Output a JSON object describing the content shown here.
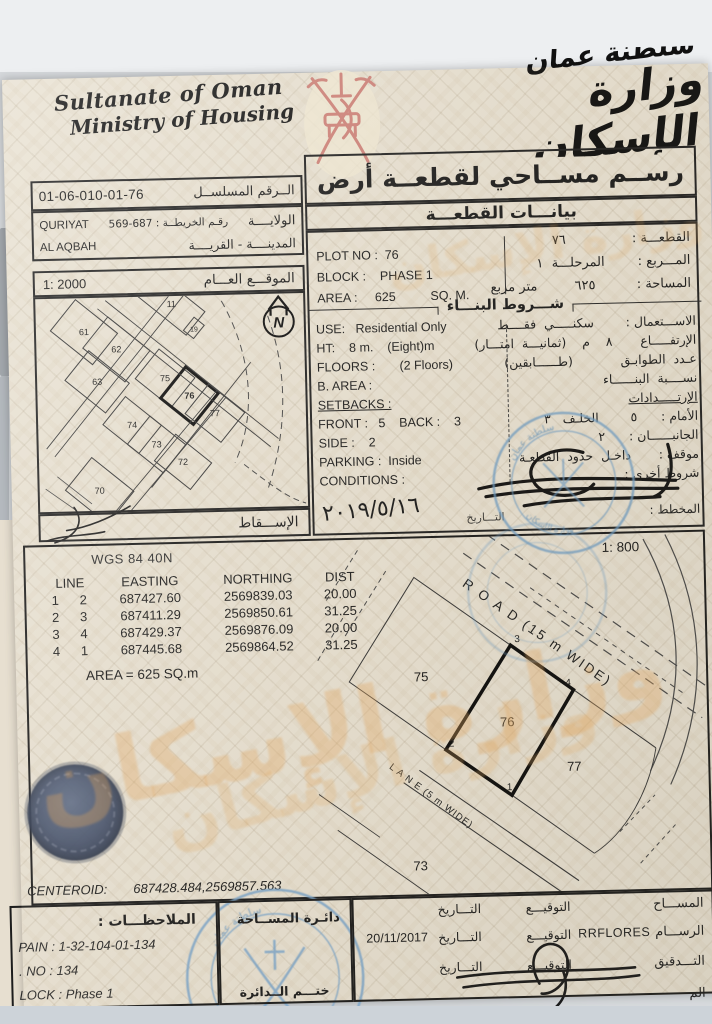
{
  "header": {
    "en_line1": "Sultanate of Oman",
    "en_line2": "Ministry of Housing",
    "ar_top": "سلطنة عمان",
    "ar_main": "وزارة الإسكان",
    "emblem": "oman-national-emblem"
  },
  "serial": {
    "label": "الــرقم  المسلســل",
    "value": "01-06-010-01-76"
  },
  "region": {
    "wilaya_label": "الولايــــة",
    "map_no": "رقـم الخريطــة :  687-569",
    "wilaya_value": "QURIYAT",
    "city_label": "المدينــــة - القريــــة",
    "city_value": "AL AQBAH"
  },
  "doc_title": {
    "main": "رســم  مســاحي  لقطعــة  أرض",
    "sub": "بيانـــات  القطعـــة"
  },
  "plot_info": {
    "ar": [
      "القطعـــة :                ٧٦",
      "المـــربع :        المرحلـــة  ١",
      "المساحة :          ٦٢٥         متر مربع"
    ],
    "en": [
      "PLOT NO :  76",
      "BLOCK :    PHASE 1",
      "AREA :     625          SQ. M."
    ]
  },
  "building": {
    "header": "شـــروط  البنـــاء",
    "rows": [
      {
        "en": "USE:   Residential Only",
        "ar": "الاســـتعمال :        سكنـــــي  فقــــط"
      },
      {
        "en": "HT:    8 m.    (Eight)m",
        "ar": "الإرتفـــــاع       ٨    م    (ثمانيـــة  امتـــار)"
      },
      {
        "en": "FLOORS :       (2 Floors)",
        "ar": "عـدد  الطوابـق            (طــــــابقين)"
      },
      {
        "en": "B. AREA :",
        "ar": "نســــبة  البنــــــاء"
      },
      {
        "en": "SETBACKS :",
        "ar": "الإرتـــــدادات"
      },
      {
        "en": "FRONT :   5    BACK :    3",
        "ar": "الأمام :      ٥        الخلـف   ٣"
      },
      {
        "en": "SIDE :    2",
        "ar": "الجانبــــــان :      ٢"
      },
      {
        "en": "PARKING :  Inside",
        "ar": "موقف :       داخـل  حدود  القطعـة"
      },
      {
        "en": "CONDITIONS :",
        "ar": "شروط أخرى :"
      }
    ],
    "planner_label": "المخطط :",
    "date_label": "التـــاريخ",
    "date_handwritten": "٢٠١٩/٥/١٦"
  },
  "site_map": {
    "label": "الموقـــع  العـــام",
    "scale": "1: 2000",
    "projection_label": "الإســـقاط",
    "north": "N",
    "labels": [
      "61",
      "62",
      "63",
      "70",
      "74",
      "73",
      "72",
      "75",
      "76",
      "77",
      "11",
      "19"
    ]
  },
  "survey": {
    "datum": "WGS 84  40N",
    "scale": "1: 800",
    "headers": [
      "LINE",
      "EASTING",
      "NORTHING",
      "DIST"
    ],
    "rows": [
      [
        "1",
        "2",
        "687427.60",
        "2569839.03",
        "20.00"
      ],
      [
        "2",
        "3",
        "687411.29",
        "2569850.61",
        "31.25"
      ],
      [
        "3",
        "4",
        "687429.37",
        "2569876.09",
        "20.00"
      ],
      [
        "4",
        "1",
        "687445.68",
        "2569864.52",
        "31.25"
      ]
    ],
    "area_line": "AREA = 625  SQ.m",
    "centeroid_label": "CENTEROID:",
    "centeroid_value": "687428.484,2569857.563"
  },
  "detail_map": {
    "plot_label": "76",
    "neighbors": [
      "75",
      "77",
      "73"
    ],
    "corners": [
      "1",
      "2",
      "3",
      "4"
    ],
    "road": "R O A D (15 m WIDE)",
    "lane": "L A N E (5 m WIDE)"
  },
  "notes": {
    "header": "الملاحظـــات :",
    "lines": [
      "PAIN : 1-32-104-01-134",
      ". NO : 134",
      "LOCK : Phase 1"
    ]
  },
  "dept": {
    "name": "دائـرة  المســاحة",
    "seal_label": "ختـــم  الــدائرة"
  },
  "signoff": {
    "sign_label": "التوقيـــع",
    "date_label": "التـــاريخ",
    "rows": [
      {
        "label": "المســـاح",
        "value": "",
        "date": ""
      },
      {
        "label": "الرســـام",
        "value": "RRFLORES",
        "date": "20/11/2017"
      },
      {
        "label": "التـــدقيق",
        "value": "",
        "date": ""
      },
      {
        "label": "الم",
        "value": "",
        "date": ""
      }
    ]
  },
  "watermark": {
    "text": "وزارة الإسكان"
  },
  "colors": {
    "paper": "#e9e2d3",
    "ink": "#1f1f1f",
    "stamp_blue": "#6f9ec6",
    "emblem_red": "#cd7f76",
    "watermark_orange": "#e0aa66",
    "seal_navy": "#3e4b66"
  }
}
